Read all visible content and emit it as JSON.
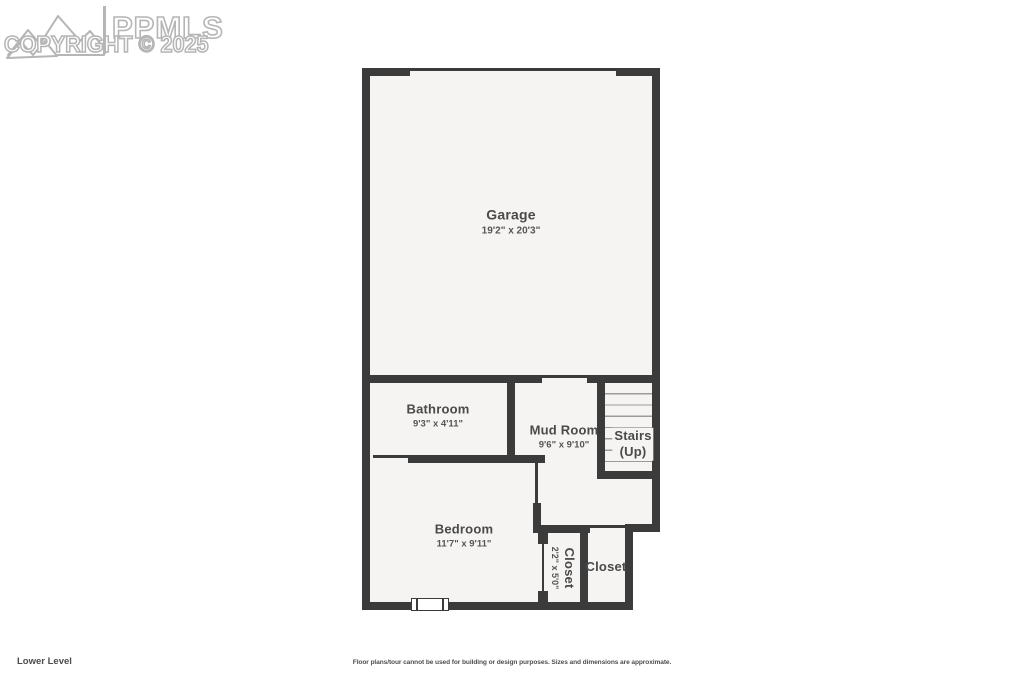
{
  "watermark": {
    "brand": "PPMLS",
    "copyright": "COPYRIGHT © 2025"
  },
  "rooms": {
    "garage": {
      "name": "Garage",
      "dims": "19'2\" x 20'3\""
    },
    "bathroom": {
      "name": "Bathroom",
      "dims": "9'3\" x 4'11\""
    },
    "mudroom": {
      "name": "Mud Room",
      "dims": "9'6\" x 9'10\""
    },
    "stairs": {
      "name": "Stairs",
      "sub": "(Up)"
    },
    "bedroom": {
      "name": "Bedroom",
      "dims": "11'7\" x 9'11\""
    },
    "closet_left": {
      "name": "Closet",
      "dims": "2'2\" x 5'0\""
    },
    "closet_right": {
      "name": "Closet"
    }
  },
  "footer": {
    "level_label": "Lower Level",
    "disclaimer": "Floor plans/tour cannot be used for building or design purposes. Sizes and dimensions are approximate."
  },
  "colors": {
    "wall": "#3b3b3b",
    "floor": "#f5f4f2",
    "label": "#4a4a4a",
    "watermark_outline": "#b5b5b5"
  }
}
